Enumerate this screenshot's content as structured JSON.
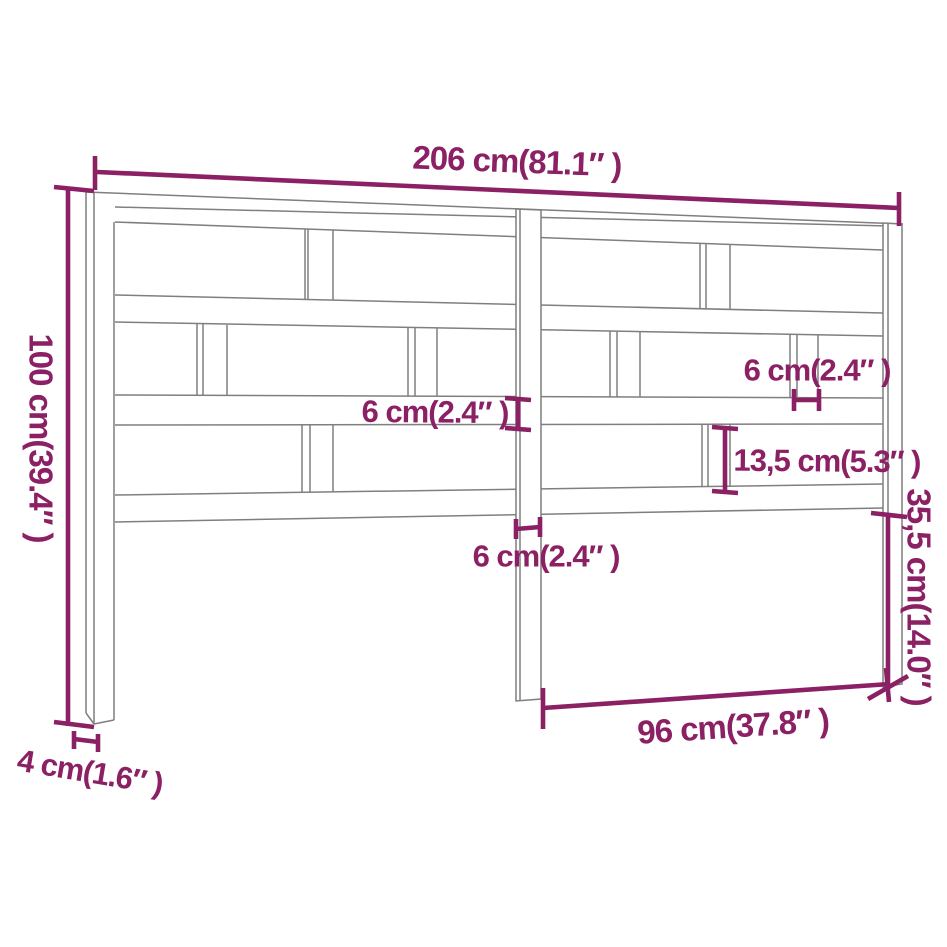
{
  "diagram": {
    "subject": "headboard-dimension-diagram",
    "labels": {
      "total_width": "206 cm(81.1″ )",
      "total_height": "100 cm(39.4″ )",
      "rail_thickness": "6 cm(2.4″ )",
      "slat_width": "6 cm(2.4″ )",
      "center_post_width": "6 cm(2.4″ )",
      "slat_row_height": "13,5 cm(5.3″ )",
      "lower_right_height": "35,5 cm(14.0″ )",
      "bottom_opening_width": "96 cm(37.8″ )",
      "leg_thickness": "4 cm(1.6″ )"
    },
    "colors": {
      "dimension": "#8B2064",
      "outline": "#7F7F7F",
      "background": "#FFFFFF"
    }
  }
}
